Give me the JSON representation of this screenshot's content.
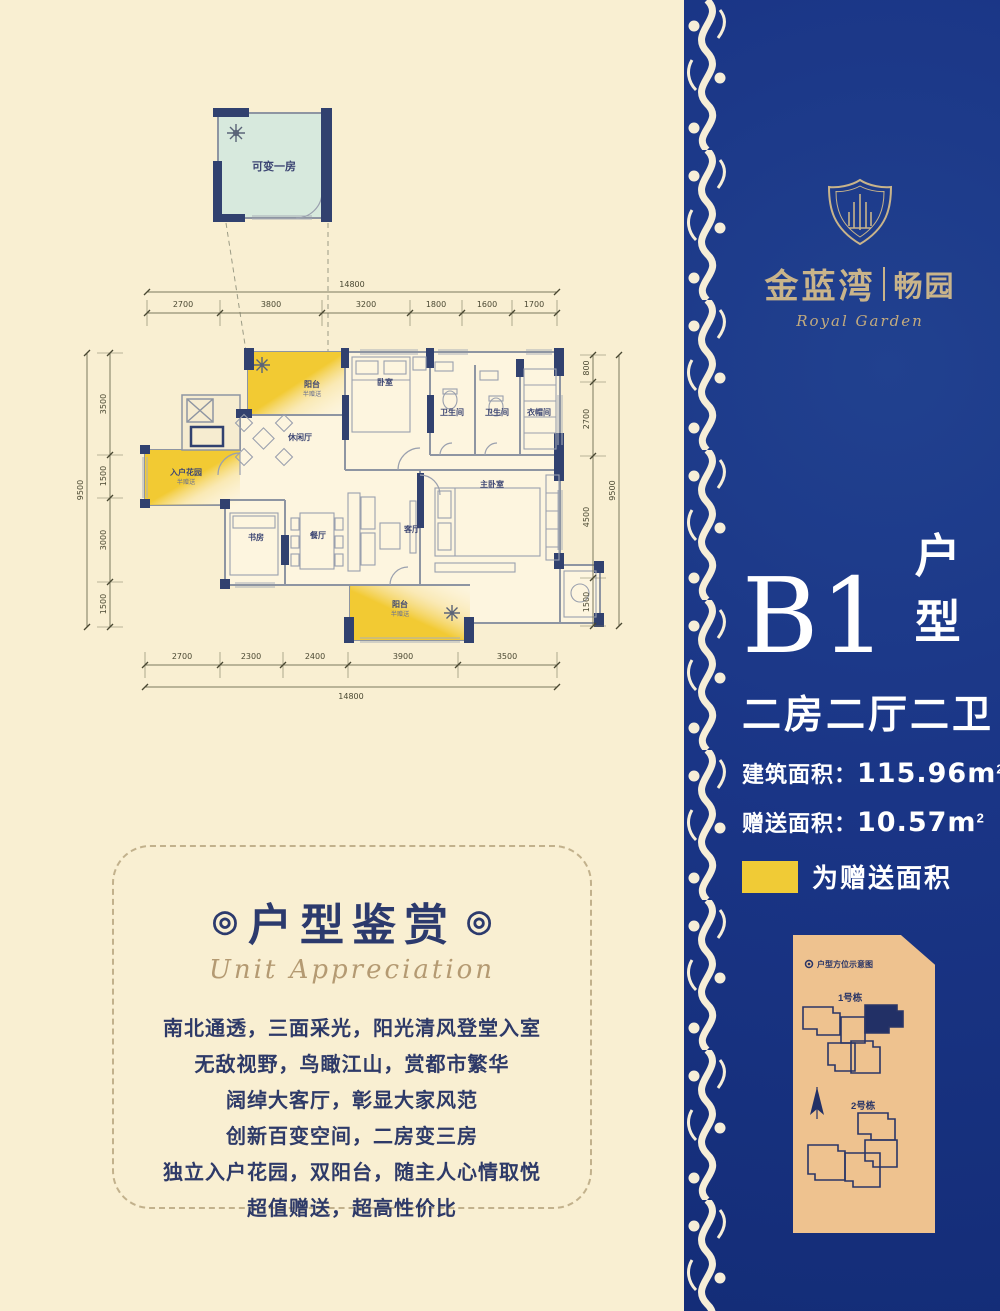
{
  "colors": {
    "background_cream": "#f9efd2",
    "panel_blue": "#1a3586",
    "brand_gold": "#c9b48a",
    "gift_yellow": "#f0cb36",
    "site_panel_tan": "#eec28f",
    "wall_navy": "#31416f",
    "text_navy": "#2e3a68",
    "convertible_room_green": "#d7e9dd"
  },
  "brand": {
    "name_left": "金蓝湾",
    "name_right": "畅园",
    "script": "Royal Garden"
  },
  "unit_panel": {
    "code": "B1",
    "code_suffix": "户型",
    "rooms_line": "二房二厅二卫",
    "built_label": "建筑面积：",
    "built_value": "115.96",
    "gift_label": "赠送面积：",
    "gift_value": "10.57",
    "unit_base": "m",
    "unit_exp": "2",
    "legend_text": "为赠送面积"
  },
  "floor_plan": {
    "rooms": [
      {
        "label": "可变一房",
        "x": 214,
        "y": 75,
        "size": 11
      },
      {
        "label": "阳台",
        "sub": "半赠送",
        "x": 252,
        "y": 292
      },
      {
        "label": "卧室",
        "x": 325,
        "y": 290
      },
      {
        "label": "卫生间",
        "x": 392,
        "y": 320
      },
      {
        "label": "卫生间",
        "x": 437,
        "y": 320
      },
      {
        "label": "衣帽间",
        "x": 479,
        "y": 320
      },
      {
        "label": "休闲厅",
        "x": 240,
        "y": 345
      },
      {
        "label": "入户花园",
        "sub": "半赠送",
        "x": 126,
        "y": 380
      },
      {
        "label": "书房",
        "x": 196,
        "y": 445
      },
      {
        "label": "餐厅",
        "x": 258,
        "y": 443
      },
      {
        "label": "客厅",
        "x": 352,
        "y": 437
      },
      {
        "label": "主卧室",
        "x": 432,
        "y": 392
      },
      {
        "label": "阳台",
        "sub": "半赠送",
        "x": 340,
        "y": 512
      }
    ],
    "dims": {
      "top": {
        "total": "14800",
        "seg_y": 218,
        "label_y": 212,
        "total_y": 197,
        "total_label_y": 192,
        "x1": 87,
        "x2": 497,
        "ticks": [
          87,
          160,
          262,
          350,
          402,
          452,
          497
        ],
        "labels": [
          {
            "t": "2700",
            "x": 123
          },
          {
            "t": "3800",
            "x": 211
          },
          {
            "t": "3200",
            "x": 306
          },
          {
            "t": "1800",
            "x": 376
          },
          {
            "t": "1600",
            "x": 427
          },
          {
            "t": "1700",
            "x": 474
          }
        ]
      },
      "bottom": {
        "total": "14800",
        "seg_y": 570,
        "label_y": 564,
        "total_y": 592,
        "total_label_y": 604,
        "x1": 85,
        "x2": 497,
        "ticks": [
          85,
          160,
          223,
          288,
          398,
          497
        ],
        "labels": [
          {
            "t": "2700",
            "x": 122
          },
          {
            "t": "2300",
            "x": 191
          },
          {
            "t": "2400",
            "x": 255
          },
          {
            "t": "3900",
            "x": 343
          },
          {
            "t": "3500",
            "x": 447
          }
        ]
      },
      "left": {
        "total": "9500",
        "seg_x": 50,
        "label_x": 46,
        "total_x": 27,
        "total_label_x": 23,
        "y1": 258,
        "y2": 532,
        "ticks": [
          258,
          360,
          403,
          487,
          532
        ],
        "labels": [
          {
            "t": "3500",
            "y": 309
          },
          {
            "t": "1500",
            "y": 381
          },
          {
            "t": "3000",
            "y": 445
          },
          {
            "t": "1500",
            "y": 509
          }
        ]
      },
      "right": {
        "total": "9500",
        "seg_x": 533,
        "label_x": 529,
        "total_x": 559,
        "total_label_x": 555,
        "y1": 260,
        "y2": 531,
        "ticks": [
          260,
          287,
          361,
          483,
          531
        ],
        "labels": [
          {
            "t": "800",
            "y": 273
          },
          {
            "t": "2700",
            "y": 324
          },
          {
            "t": "4500",
            "y": 422
          },
          {
            "t": "1500",
            "y": 507
          }
        ]
      }
    }
  },
  "appreciation": {
    "decor": "◎",
    "title": "户型鉴赏",
    "subtitle": "Unit Appreciation",
    "lines": [
      "南北通透，三面采光，阳光清风登堂入室",
      "无敌视野，鸟瞰江山，赏都市繁华",
      "阔绰大客厅，彰显大家风范",
      "创新百变空间，二房变三房",
      "独立入户花园，双阳台，随主人心情取悦",
      "超值赠送，超高性价比"
    ]
  },
  "site_map": {
    "title": "户型方位示意图",
    "building1": "1号栋",
    "building2": "2号栋"
  }
}
